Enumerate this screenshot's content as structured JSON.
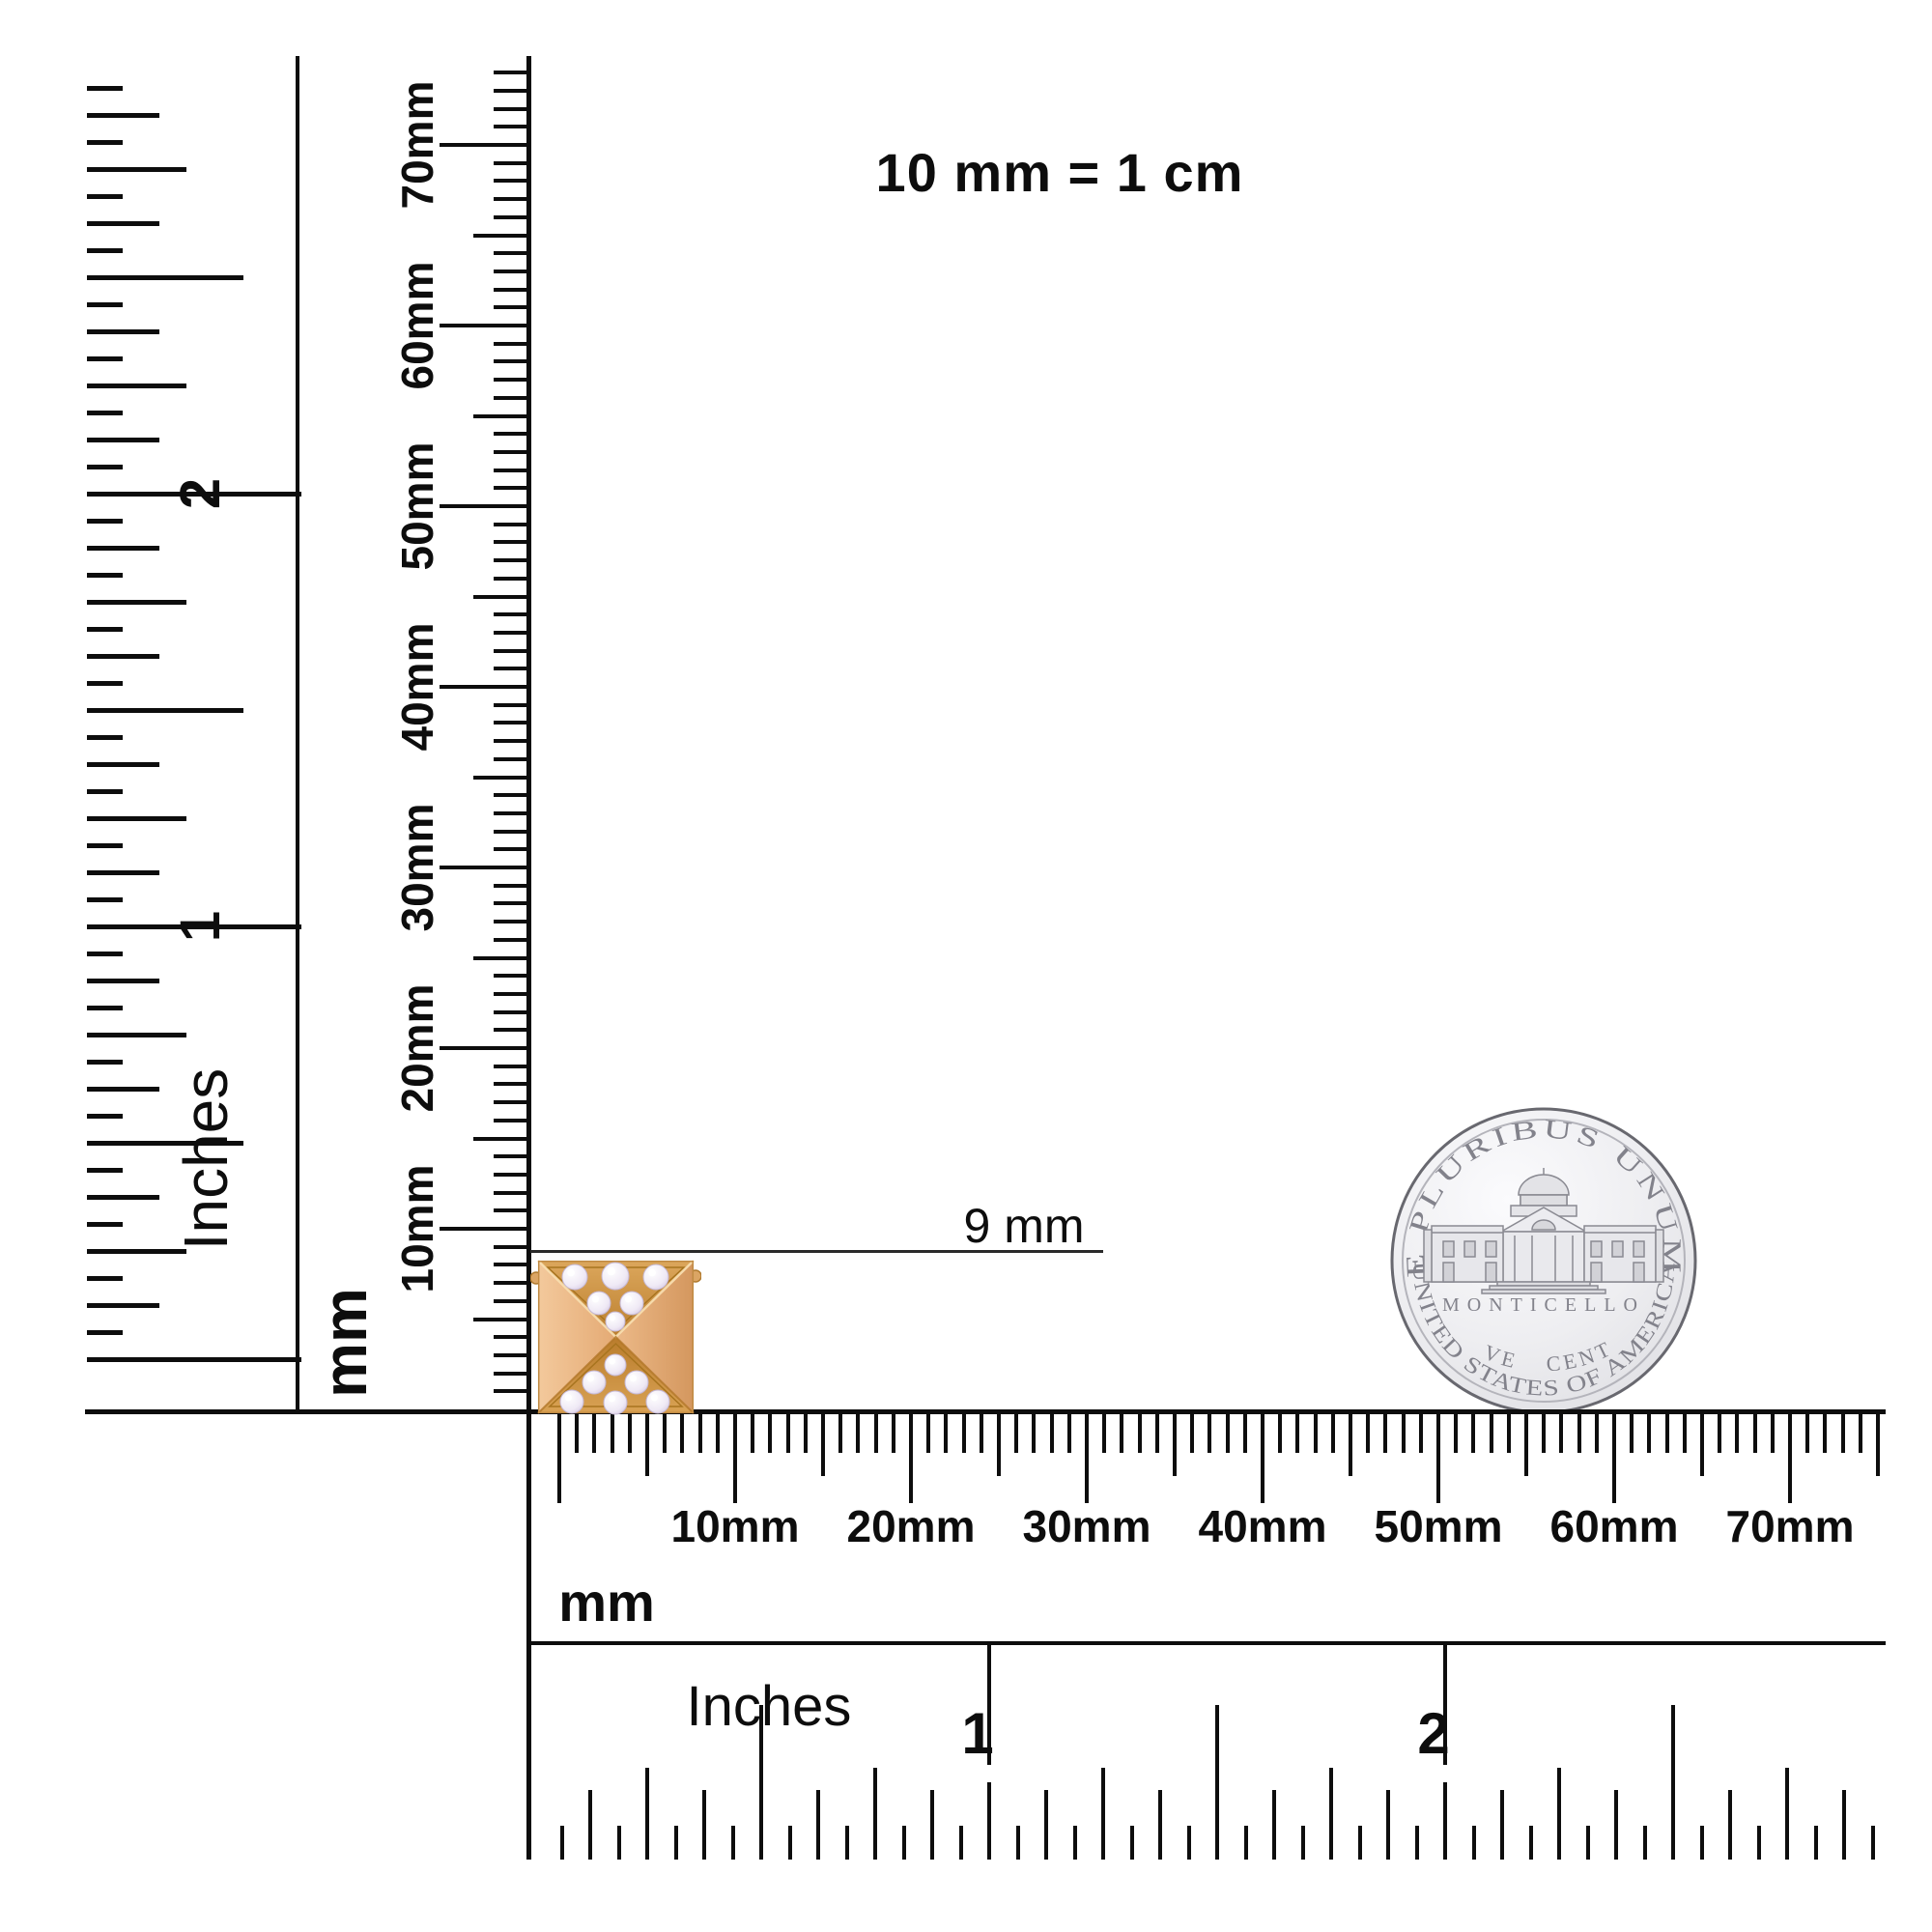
{
  "scale_note": {
    "text": "10 mm = 1 cm"
  },
  "measurement": {
    "label": "9 mm"
  },
  "colors": {
    "ink": "#0d0d0d",
    "rose_gold_light": "#f0c496",
    "rose_gold_mid": "#e2a871",
    "rose_gold_dark": "#c8873f",
    "pave_gold": "#b9801f",
    "diamond_white": "#f4eff8",
    "coin_field": "#efeff2",
    "coin_edge": "#68686f",
    "coin_letter": "#82828b"
  },
  "rulers": {
    "left_inches": {
      "unit_label": "Inches",
      "axis": "y",
      "anchor": 90,
      "grow": 1,
      "zero": 1407,
      "step": 28.0,
      "n0": 0,
      "n1": 47,
      "thick": 5,
      "divs": [
        16,
        8,
        4,
        2
      ],
      "lens": [
        222,
        162,
        103,
        75,
        37
      ],
      "label_ns": [
        16,
        32
      ],
      "labels": [
        "1",
        "2"
      ],
      "labelX": 208,
      "labelClass": "numeral-v rot"
    },
    "left_mm": {
      "unit_label": "mm",
      "axis": "y",
      "anchor": 545,
      "grow": -1,
      "zero": 1459,
      "step": 18.7,
      "n0": 1,
      "n1": 74,
      "thick": 4,
      "divs": [
        10,
        5
      ],
      "lens": [
        90,
        55,
        34
      ],
      "label_ns": [
        10,
        20,
        30,
        40,
        50,
        60,
        70
      ],
      "labels": [
        "10mm",
        "20mm",
        "30mm",
        "40mm",
        "50mm",
        "60mm",
        "70mm"
      ],
      "labelX": 432,
      "labelClass": "mmlab rot"
    },
    "bottom_mm": {
      "unit_label": "mm",
      "axis": "x",
      "anchor": 1464,
      "grow": 1,
      "zero": 579,
      "step": 18.2,
      "n0": 0,
      "n1": 75,
      "thick": 4,
      "divs": [
        10,
        5
      ],
      "lens": [
        92,
        64,
        40
      ],
      "label_ns": [
        10,
        20,
        30,
        40,
        50,
        60,
        70
      ],
      "labels": [
        "10mm",
        "20mm",
        "30mm",
        "40mm",
        "50mm",
        "60mm",
        "70mm"
      ],
      "labelY": 1580,
      "labelClass": "mmlab"
    },
    "bottom_inches": {
      "unit_label": "Inches",
      "axis": "x",
      "anchor": 1925,
      "grow": -1,
      "zero": 552,
      "step": 29.5,
      "n0": 1,
      "n1": 47,
      "thick": 4,
      "divs": [
        16,
        8,
        4,
        2
      ],
      "lens": [
        80,
        160,
        95,
        72,
        35
      ],
      "label_ns": [
        16,
        32
      ],
      "labels": [
        "1",
        "2"
      ],
      "labelY": 1795,
      "labelDX": -12,
      "labelClass": "numeral",
      "topTick": {
        "from": 1703,
        "len": 124
      }
    }
  },
  "coin": {
    "legend_top": "E PLURIBUS UNUM",
    "building_label": "MONTICELLO",
    "denomination": "FIVE CENTS",
    "legend_bottom": "UNITED STATES OF AMERICA"
  },
  "earring": {
    "stones_top": [
      [
        38,
        17,
        13
      ],
      [
        80,
        16,
        14
      ],
      [
        122,
        17,
        13
      ],
      [
        63,
        44,
        12
      ],
      [
        97,
        44,
        12
      ],
      [
        80,
        63,
        10
      ]
    ],
    "stones_bottom": [
      [
        80,
        108,
        11
      ],
      [
        58,
        126,
        12
      ],
      [
        102,
        126,
        12
      ],
      [
        35,
        146,
        12
      ],
      [
        80,
        147,
        12
      ],
      [
        124,
        146,
        12
      ]
    ]
  }
}
